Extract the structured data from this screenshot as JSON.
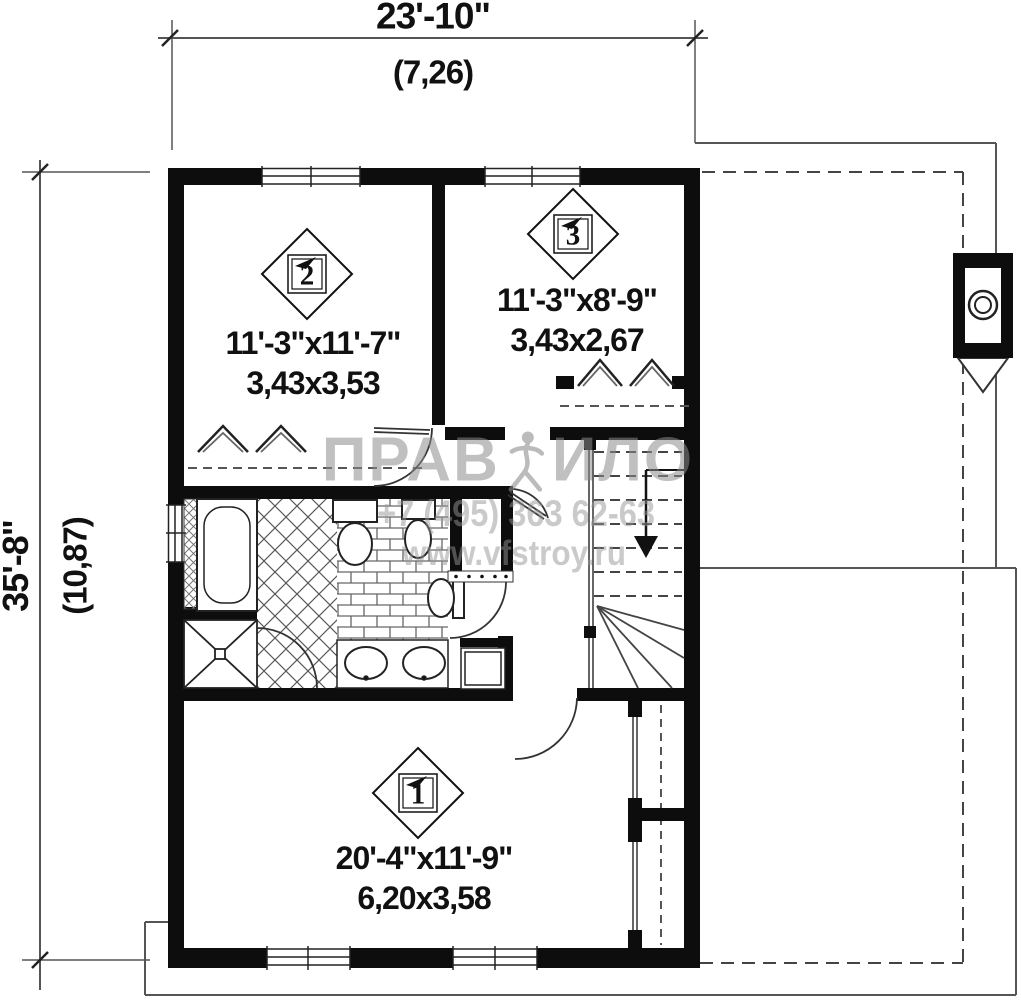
{
  "dimensions": {
    "width": {
      "imperial": "23'-10\"",
      "metric": "(7,26)"
    },
    "height": {
      "imperial": "35'-8\"",
      "metric": "(10,87)"
    }
  },
  "rooms": {
    "room1": {
      "number": "1",
      "size_imperial": "20'-4\"x11'-9\"",
      "size_metric": "6,20x3,58"
    },
    "room2": {
      "number": "2",
      "size_imperial": "11'-3\"x11'-7\"",
      "size_metric": "3,43x3,53"
    },
    "room3": {
      "number": "3",
      "size_imperial": "11'-3\"x8'-9\"",
      "size_metric": "3,43x2,67"
    }
  },
  "watermark": {
    "brand_left": "ПРАВ",
    "brand_right": "ИЛО",
    "phone": "+7 (495) 363 62-63",
    "url": "www.vfstroy.ru"
  },
  "colors": {
    "wall": "#0d0d0d",
    "thin_line": "#555555",
    "watermark_gray": "#8f8f8f"
  }
}
